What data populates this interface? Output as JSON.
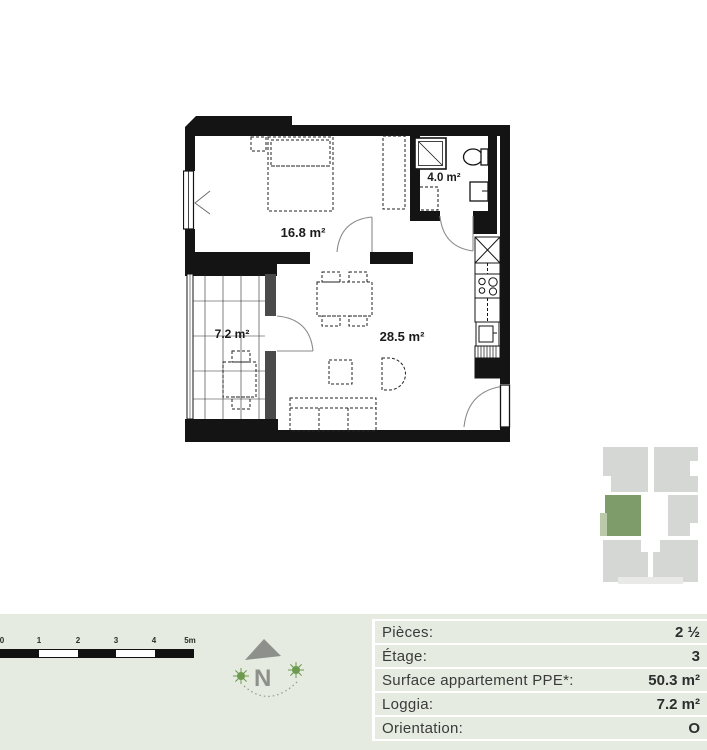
{
  "plan": {
    "rooms": [
      {
        "name": "bedroom",
        "area": "16.8 m²"
      },
      {
        "name": "bathroom",
        "area": "4.0 m²"
      },
      {
        "name": "loggia",
        "area": "7.2 m²"
      },
      {
        "name": "living",
        "area": "28.5 m²"
      }
    ]
  },
  "scalebar": {
    "labels": [
      "0",
      "1",
      "2",
      "3",
      "4",
      "5m"
    ]
  },
  "compass": {
    "label": "N"
  },
  "details_table": {
    "rows": [
      {
        "label": "Pièces:",
        "value": "2 ½"
      },
      {
        "label": "Étage:",
        "value": "3"
      },
      {
        "label": "Surface appartement PPE*:",
        "value": "50.3 m²"
      },
      {
        "label": "Loggia:",
        "value": "7.2 m²"
      },
      {
        "label": "Orientation:",
        "value": "O"
      }
    ]
  },
  "minimap": {
    "highlight_color": "#7e9c6a",
    "loggia_color": "#bac9a7",
    "block_color": "#d5d7d4"
  },
  "colors": {
    "band_background": "#e5ebe0",
    "wall": "#141414"
  }
}
